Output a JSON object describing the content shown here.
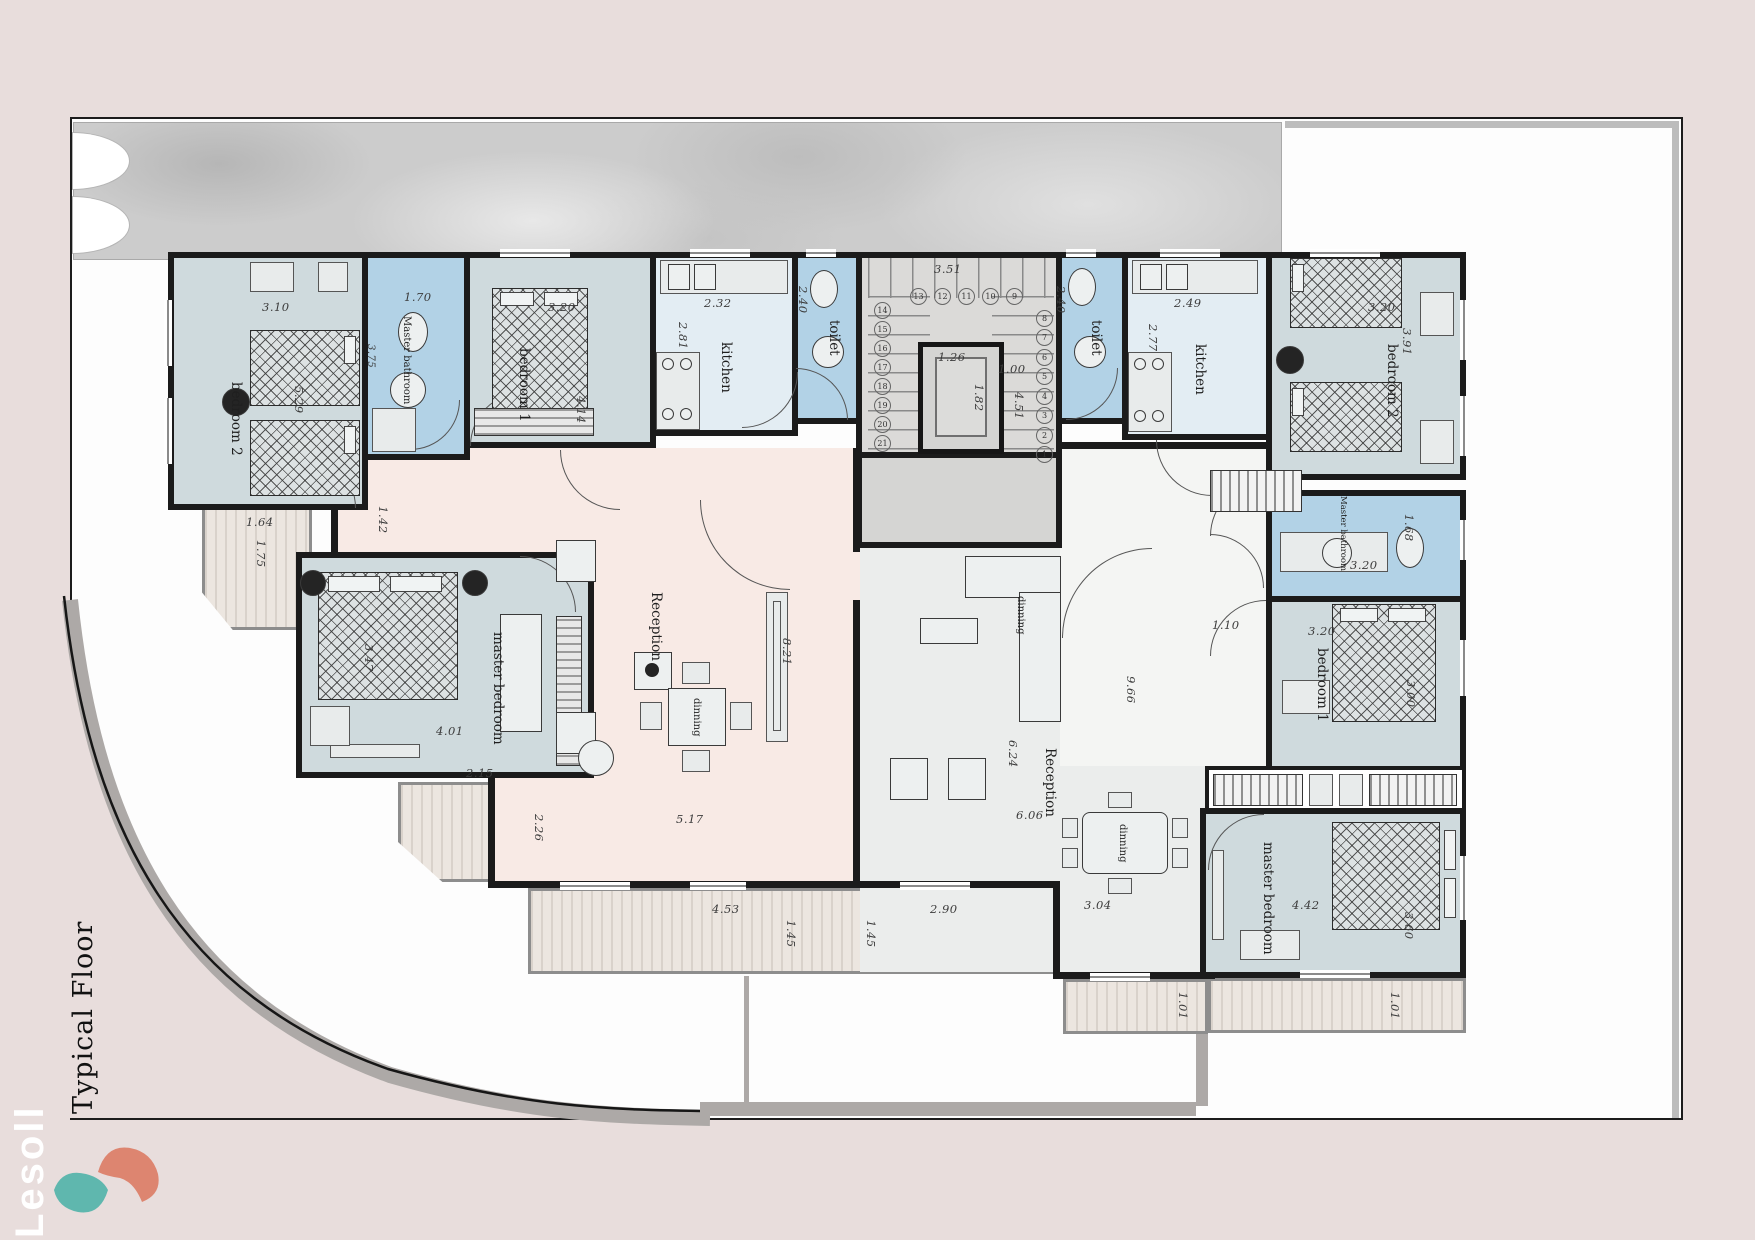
{
  "title": "Typical Floor",
  "watermark": "Lesoll",
  "palette": {
    "background": "#e8dddc",
    "sheet": "#fdfdfd",
    "wall": "#1b1b1b",
    "bedroom": "#cfdadd",
    "bathroom": "#b2d2e6",
    "kitchen": "#e3edf3",
    "reception_left": "#f8eae5",
    "reception_right": "#ebedec",
    "balcony": "#ece6e0",
    "sidewalk": "#ada9a7",
    "logo_teal": "#5fb7ae",
    "logo_coral": "#dd8570"
  },
  "core": {
    "stair_width": "3.51",
    "landing": "1.00",
    "stair_len": "4.51",
    "elev_w": "1.26",
    "elev_d": "1.82",
    "steps": [
      1,
      2,
      3,
      4,
      5,
      6,
      7,
      8,
      9,
      10,
      11,
      12,
      13,
      14,
      15,
      16,
      17,
      18,
      19,
      20,
      21
    ]
  },
  "left": {
    "bedroom2": {
      "label": "bedroom 2",
      "w": "3.10",
      "h": "5.29"
    },
    "master_bathroom": {
      "label": "Master bathroom",
      "w": "1.70",
      "h": "3.75"
    },
    "bedroom1": {
      "label": "bedroom 1",
      "w": "3.20",
      "h": "4.14"
    },
    "kitchen": {
      "label": "kitchen",
      "w": "2.32",
      "h": "2.81"
    },
    "toilet": {
      "label": "toilet",
      "h": "2.40"
    },
    "hall": "1.42",
    "master_bedroom": {
      "label": "master bedroom",
      "w": "4.01",
      "h": "3.47"
    },
    "reception": {
      "label": "Reception",
      "h": "8.21",
      "w": "5.17"
    },
    "dinning": {
      "label": "dinning"
    },
    "balcony1": {
      "w": "1.64",
      "h": "1.75"
    },
    "balcony2": {
      "w": "2.15",
      "h": "2.26"
    },
    "balcony3": {
      "w": "4.53",
      "h": "1.45"
    }
  },
  "right": {
    "toilet": {
      "label": "toilet",
      "h": "2.40"
    },
    "kitchen": {
      "label": "kitchen",
      "w": "2.49",
      "h": "2.77"
    },
    "bedroom2": {
      "label": "bedroom 2",
      "w": "3.20",
      "h": "3.91"
    },
    "master_bathroom": {
      "label": "Master bathroom",
      "w": "3.20",
      "h": "1.68"
    },
    "bedroom1": {
      "label": "bedroom 1",
      "w": "3.20",
      "h": "3.00"
    },
    "hall": {
      "w": "1.10",
      "h": "9.66"
    },
    "master_bedroom": {
      "label": "master bedroom",
      "w": "4.42",
      "h": "3.60"
    },
    "reception": {
      "label": "Reception",
      "h": "6.24",
      "w": "6.06"
    },
    "dinning": {
      "label": "dinning",
      "w": "3.04"
    },
    "dinning2": {
      "label": "dinning"
    },
    "balcony1": {
      "w": "2.90",
      "h": "1.45"
    },
    "balcony2": {
      "h": "1.01"
    },
    "balcony3": {
      "h": "1.01"
    }
  }
}
